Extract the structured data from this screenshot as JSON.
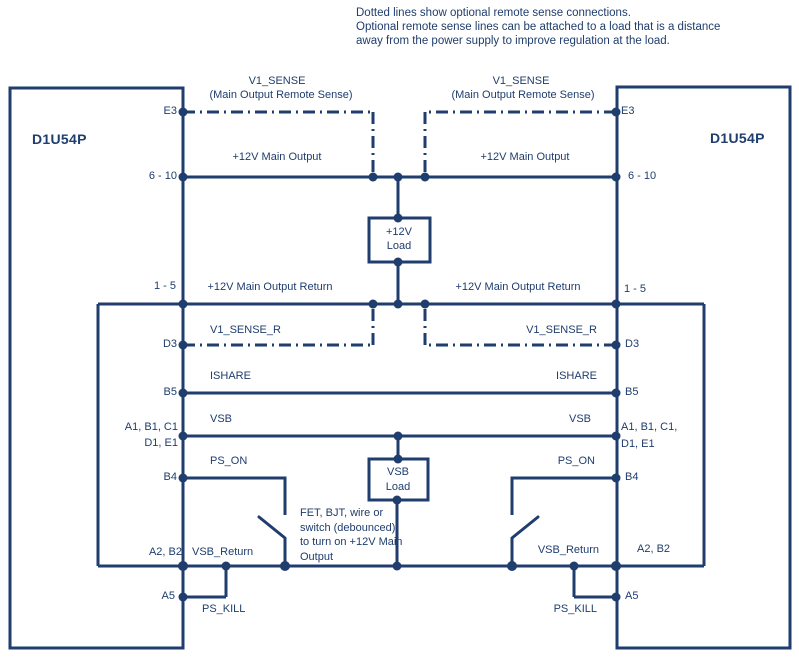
{
  "colors": {
    "ink": "#1f3d6d"
  },
  "annotation": {
    "line1": "Dotted lines show optional remote sense connections.",
    "line2": "Optional remote sense lines can be attached to a load that is a distance",
    "line3": "away from the power supply to improve regulation at the load."
  },
  "left_psu": {
    "title": "D1U54P",
    "pin_e3": "E3",
    "pin_main": "6 - 10",
    "pin_return": "1 - 5",
    "pin_d3": "D3",
    "pin_b5": "B5",
    "pin_vsb_a": "A1, B1, C1",
    "pin_vsb_b": "D1, E1",
    "pin_b4": "B4",
    "pin_a2b2": "A2, B2",
    "pin_a5": "A5"
  },
  "right_psu": {
    "title": "D1U54P",
    "pin_e3": "E3",
    "pin_main": "6 - 10",
    "pin_return": "1 - 5",
    "pin_d3": "D3",
    "pin_b5": "B5",
    "pin_vsb_a": "A1, B1, C1,",
    "pin_vsb_b": "D1, E1",
    "pin_b4": "B4",
    "pin_a2b2": "A2, B2",
    "pin_a5": "A5"
  },
  "left_labels": {
    "v1_sense": "V1_SENSE",
    "v1_sense_sub": "(Main Output Remote Sense)",
    "main_output": "+12V Main Output",
    "main_return": "+12V Main Output Return",
    "v1_sense_r": "V1_SENSE_R",
    "ishare": "ISHARE",
    "vsb": "VSB",
    "ps_on": "PS_ON",
    "vsb_return": "VSB_Return",
    "ps_kill": "PS_KILL"
  },
  "right_labels": {
    "v1_sense": "V1_SENSE",
    "v1_sense_sub": "(Main Output Remote Sense)",
    "main_output": "+12V Main Output",
    "main_return": "+12V Main Output Return",
    "v1_sense_r": "V1_SENSE_R",
    "ishare": "ISHARE",
    "vsb": "VSB",
    "ps_on": "PS_ON",
    "vsb_return": "VSB_Return",
    "ps_kill": "PS_KILL"
  },
  "main_load": {
    "line1": "+12V",
    "line2": "Load"
  },
  "vsb_load": {
    "line1": "VSB",
    "line2": "Load"
  },
  "switch_note": {
    "line1": "FET, BJT, wire or",
    "line2": "switch (debounced)",
    "line3": "to turn on +12V Main",
    "line4": "Output"
  }
}
